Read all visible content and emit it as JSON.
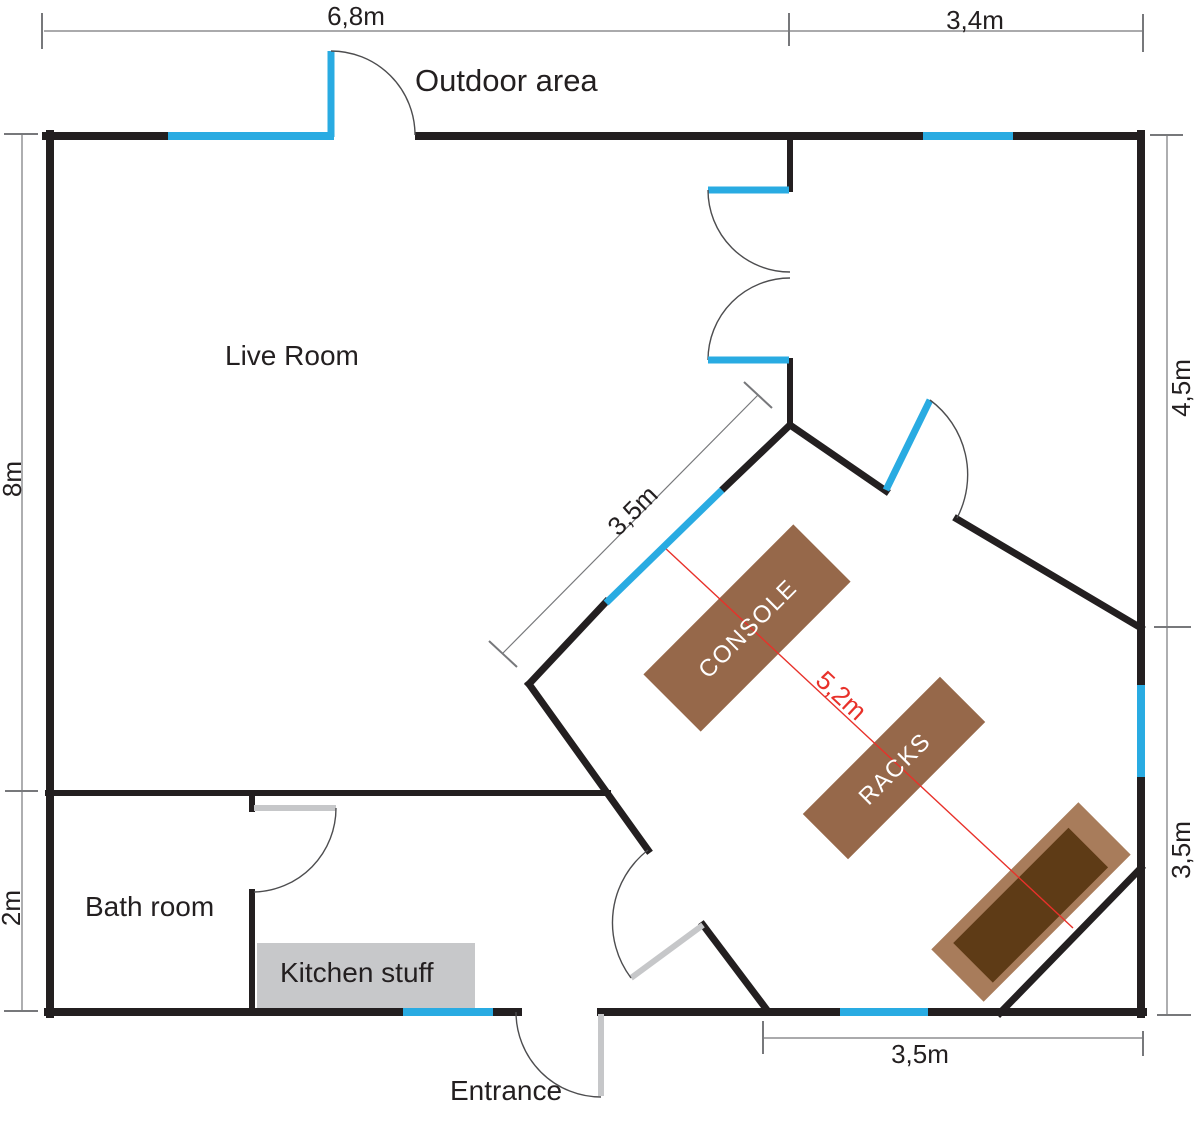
{
  "rooms": {
    "live_room": "Live Room",
    "bath_room": "Bath room",
    "kitchen": "Kitchen stuff",
    "outdoor_area": "Outdoor area",
    "entrance": "Entrance"
  },
  "furniture": {
    "console": "CONSOLE",
    "racks": "RACKS"
  },
  "dimensions": {
    "top_left_width": "6,8m",
    "top_right_width": "3,4m",
    "left_upper": "8m",
    "left_lower": "2m",
    "right_upper": "4,5m",
    "right_lower": "3,5m",
    "control_room_window_wall": "3,5m",
    "bottom_right_width": "3,5m",
    "console_to_speaker": "5,2m"
  },
  "colors": {
    "bg": "#ffffff",
    "wall": "#231f20",
    "window": "#29abe2",
    "door": "#c6c7c9",
    "arc": "#4d4d4f",
    "dim": "#77787b",
    "red": "#e8312a",
    "text": "#231f20",
    "brown": "#96684a",
    "speaker_outer": "#a87c5b",
    "speaker_inner": "#5e3b16",
    "kitchen": "#c7c8ca"
  }
}
